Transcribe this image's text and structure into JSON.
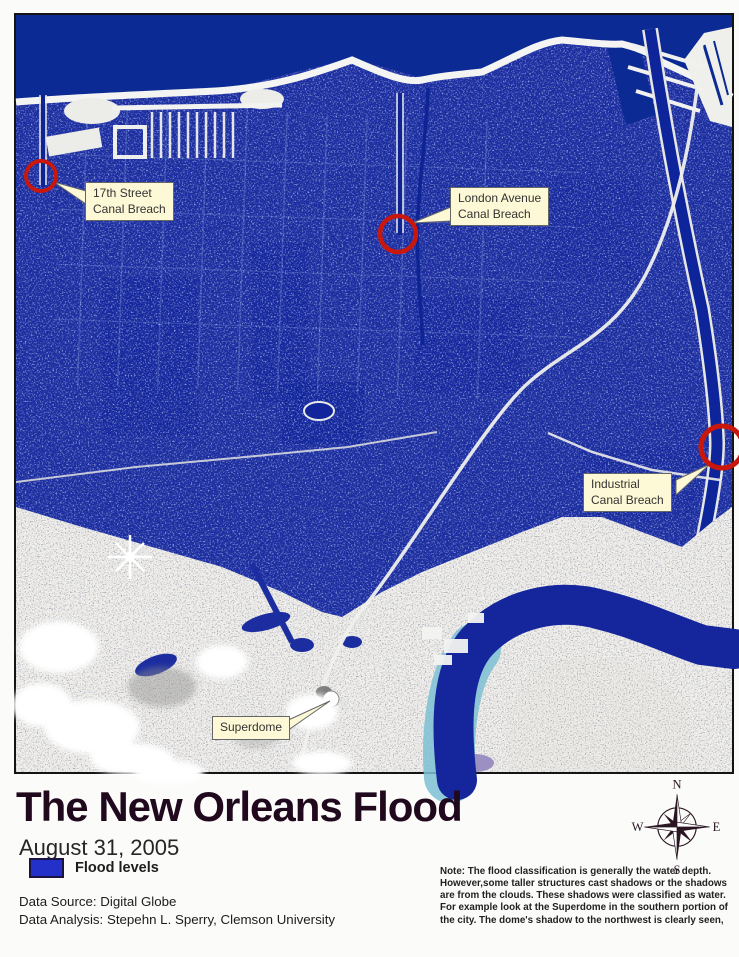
{
  "title": "The New Orleans Flood",
  "date": "August 31, 2005",
  "legend": {
    "label": "Flood levels",
    "swatch_color": "#2431c8"
  },
  "credits": {
    "source": "Data Source: Digital Globe",
    "analysis": "Data Analysis: Stepehn L. Sperry, Clemson University"
  },
  "note": {
    "lines": [
      "Note: The flood classification is generally the water depth.",
      "However,some taller structures cast shadows or the shadows",
      "are from the clouds. These shadows were classified as water.",
      "For example look at the Superdome in the southern portion of",
      "the city. The dome's shadow to the northwest is clearly seen,"
    ]
  },
  "map": {
    "callouts": {
      "c17th": {
        "line1": "17th Street",
        "line2": "Canal Breach"
      },
      "london": {
        "line1": "London Avenue",
        "line2": "Canal Breach"
      },
      "industrial": {
        "line1": "Industrial",
        "line2": "Canal Breach"
      },
      "superdome": {
        "line1": "Superdome"
      }
    },
    "colors": {
      "flood": "#1c2da0",
      "lake": "#0b2a93",
      "river": "#15259c",
      "unflooded_land": "#f0efec",
      "breach_ring": "#c9170b",
      "callout_bg": "#fdf8d6"
    }
  },
  "compass": {
    "n": "N",
    "e": "E",
    "s": "S",
    "w": "W"
  }
}
